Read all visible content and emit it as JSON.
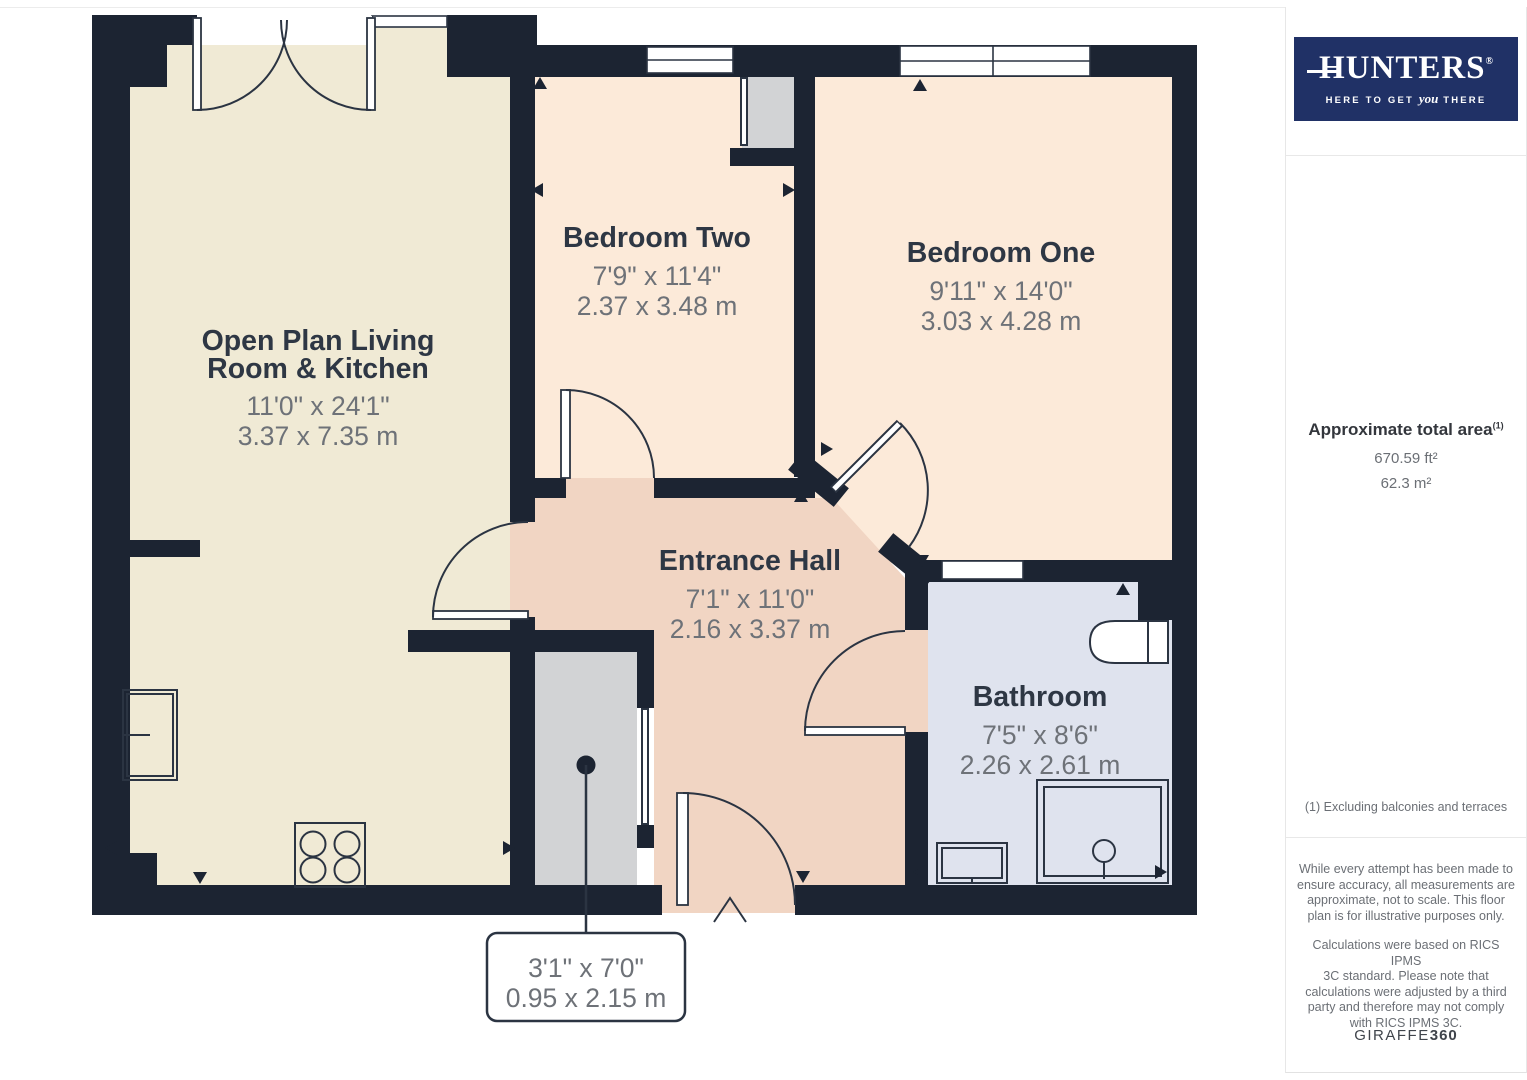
{
  "plan": {
    "rooms": {
      "living": {
        "name_line1": "Open Plan Living",
        "name_line2": "Room & Kitchen",
        "imperial": "11'0\" x 24'1\"",
        "metric": "3.37 x 7.35 m"
      },
      "bedroom2": {
        "name": "Bedroom Two",
        "imperial": "7'9\" x 11'4\"",
        "metric": "2.37 x 3.48 m"
      },
      "bedroom1": {
        "name": "Bedroom One",
        "imperial": "9'11\" x 14'0\"",
        "metric": "3.03 x 4.28 m"
      },
      "hall": {
        "name": "Entrance Hall",
        "imperial": "7'1\" x 11'0\"",
        "metric": "2.16 x 3.37 m"
      },
      "bathroom": {
        "name": "Bathroom",
        "imperial": "7'5\" x 8'6\"",
        "metric": "2.26 x 2.61 m"
      }
    },
    "cupboard_label": {
      "imperial": "3'1\" x 7'0\"",
      "metric": "0.95 x 2.15 m"
    },
    "colors": {
      "wall": "#1c2432",
      "living_floor": "#f0ead5",
      "bedroom_floor": "#fcead9",
      "hall_floor": "#f1d5c3",
      "bathroom_floor": "#dfe3ee",
      "cupboard_floor": "#d2d3d5",
      "label_text": "#2e3744",
      "dimension_text": "#6e7278"
    }
  },
  "sidebar": {
    "logo": {
      "brand": "HUNTERS",
      "registered": "®",
      "tagline_pre": "HERE TO GET ",
      "tagline_italic": "you",
      "tagline_post": " THERE",
      "background": "#203166"
    },
    "area": {
      "title": "Approximate total area",
      "title_superscript": "(1)",
      "imperial": "670.59 ft²",
      "metric": "62.3 m²",
      "footnote": "(1) Excluding balconies and terraces"
    },
    "disclaimer1": "While every attempt has been made to\nensure accuracy, all measurements are\napproximate, not to scale. This floor\nplan is for illustrative purposes only.",
    "disclaimer2": "Calculations were based on RICS IPMS\n3C standard. Please note that\ncalculations were adjusted by a third\nparty and therefore may not comply\nwith RICS IPMS 3C.",
    "credit_brand": "GIRAFFE",
    "credit_suffix": "360"
  }
}
